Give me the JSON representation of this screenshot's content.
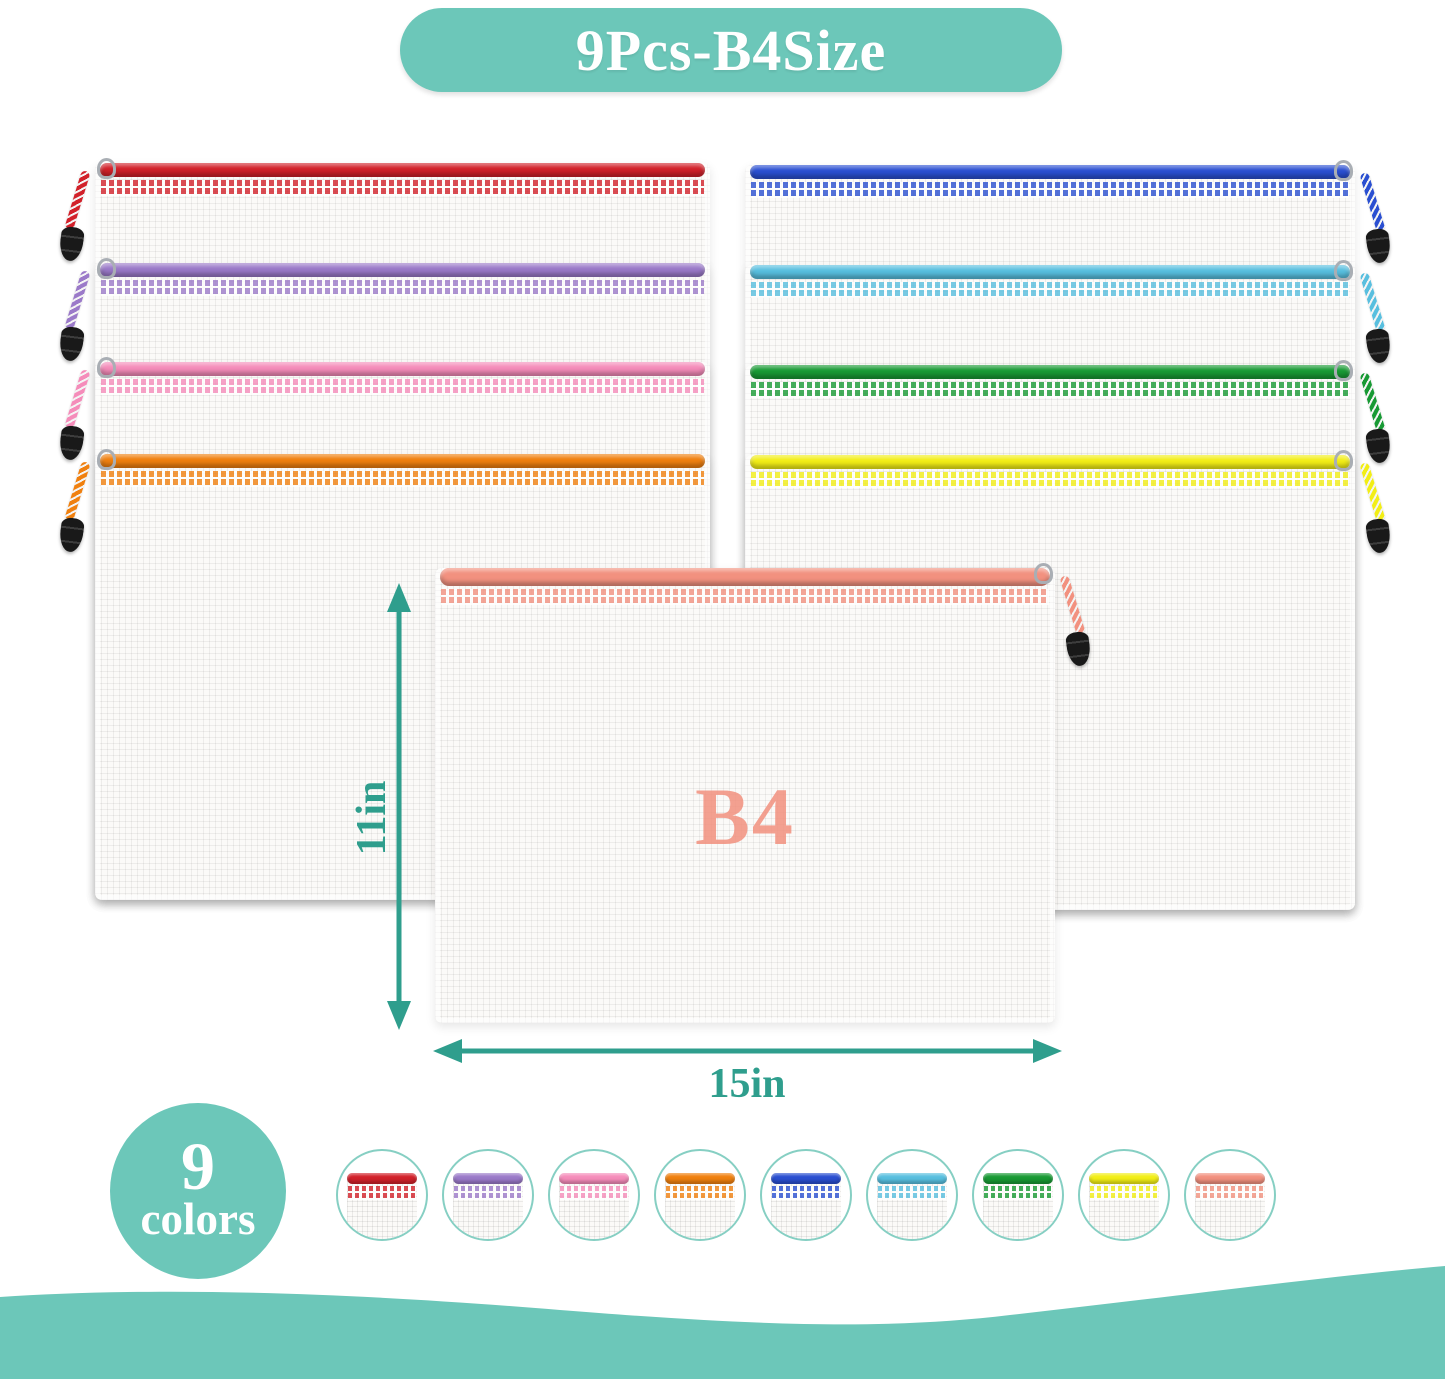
{
  "banner": {
    "label": "9Pcs-B4Size"
  },
  "front_pouch": {
    "size_label": "B4",
    "color_name": "salmon",
    "color": "#f2917f"
  },
  "dimensions": {
    "height_label": "11in",
    "width_label": "15in"
  },
  "colors_badge": {
    "count": "9",
    "label": "colors"
  },
  "pouches": {
    "left": [
      {
        "name": "red",
        "color": "#d2212a"
      },
      {
        "name": "purple",
        "color": "#9b7ac9"
      },
      {
        "name": "pink",
        "color": "#f58cba"
      },
      {
        "name": "orange",
        "color": "#f0800f"
      }
    ],
    "right": [
      {
        "name": "blue",
        "color": "#2a4fd1"
      },
      {
        "name": "sky-blue",
        "color": "#58bfdf"
      },
      {
        "name": "green",
        "color": "#189a34"
      },
      {
        "name": "yellow",
        "color": "#f2ee16"
      }
    ]
  },
  "swatches": [
    {
      "name": "red",
      "color": "#d2212a"
    },
    {
      "name": "purple",
      "color": "#9b7ac9"
    },
    {
      "name": "pink",
      "color": "#f58cba"
    },
    {
      "name": "orange",
      "color": "#f0800f"
    },
    {
      "name": "blue",
      "color": "#2a4fd1"
    },
    {
      "name": "sky-blue",
      "color": "#58bfdf"
    },
    {
      "name": "green",
      "color": "#189a34"
    },
    {
      "name": "yellow",
      "color": "#f2ee16"
    },
    {
      "name": "salmon",
      "color": "#f2917f"
    }
  ],
  "theme": {
    "teal": "#6cc7b9",
    "teal_dim_text": "#2f9e8d",
    "swatch_ring": "#86cfc3"
  }
}
